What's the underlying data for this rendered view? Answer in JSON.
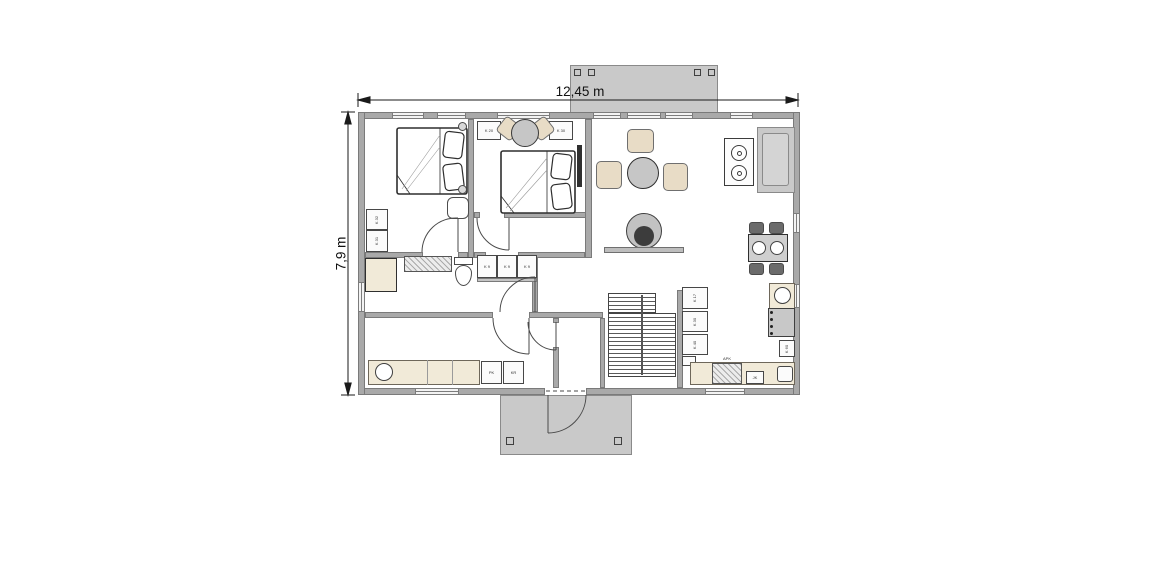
{
  "dimension_labels": {
    "width": "12,45 m",
    "height": "7,9 m"
  },
  "furniture_labels": {
    "nightstand_left": "K 20",
    "nightstand_right": "K 30",
    "wardrobe_top": "K 32",
    "wardrobe_bottom": "K 31",
    "vanity_cabinets": [
      "K 9",
      "K 9",
      "K 9"
    ],
    "kitchen_wall_cabinets": [
      "K 17",
      "K 30",
      "K 40"
    ],
    "dishwasher": "APK",
    "fridge": "JK",
    "kitchen_base_cabinet": "K 60",
    "washer": "PK",
    "dryer": "KR"
  },
  "colors": {
    "wall": "#a9a9a9",
    "terrace": "#c9c9c9",
    "counter": "#f1ead8",
    "seat": "#e8dcc6",
    "table": "#c6c6c6",
    "dark_fixture": "#3c3c3c"
  }
}
